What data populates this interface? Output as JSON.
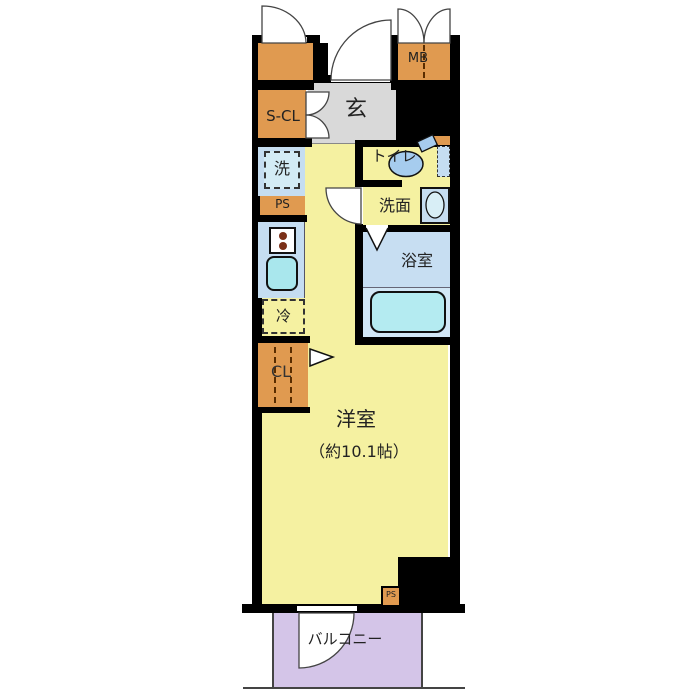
{
  "labels": {
    "s_cl": "S-CL",
    "mb": "MB",
    "entrance": "玄",
    "toilet": "トイレ",
    "washer": "洗",
    "ps_upper": "PS",
    "washroom": "洗面",
    "bath": "浴室",
    "fridge": "冷",
    "closet": "CL",
    "room": "洋室",
    "room_size": "（約10.1帖）",
    "ps_lower": "PS",
    "balcony": "バルコニー"
  },
  "colors": {
    "wall": "#000000",
    "floor": "#F5F1A1",
    "entrance_floor": "#D9D9D9",
    "storage_orange": "#E09A50",
    "fixture_blue": "#C5DDF1",
    "bath_blue": "#C7DEF2",
    "tub": "#B4EBF1",
    "sink": "#A9E7ED",
    "toilet_fixture": "#A6CCEE",
    "balcony": "#D4C5E8"
  }
}
